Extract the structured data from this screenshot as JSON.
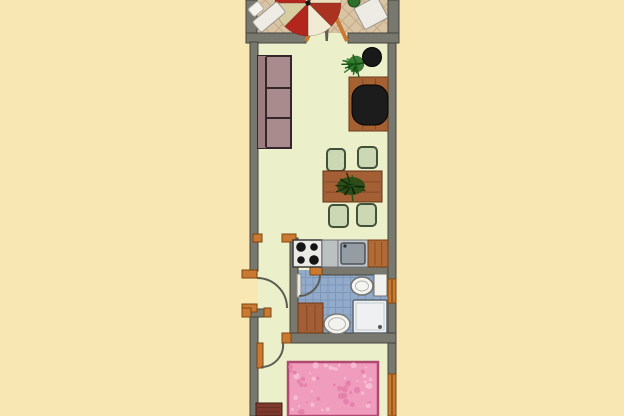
{
  "title": "apartment-floor-plan",
  "canvas": {
    "w": 624,
    "h": 416,
    "bg": "#f8e7b2"
  },
  "palette": {
    "background": "#f8e7b2",
    "wall": "#78786f",
    "wall_edge": "#45453e",
    "floor_main": "#ebefca",
    "floor_balcony": "#d9c4a4",
    "floor_bath": "#93abca",
    "wood_frame": "#c97a30",
    "wood_frame_edge": "#7d450f",
    "arc": "#5c5c54",
    "bed_pink": "#ef9cbd",
    "umbrella_red": "#b2261e"
  },
  "elements": [
    {
      "name": "background",
      "type": "rect",
      "x": 0,
      "y": 0,
      "w": 624,
      "h": 416,
      "fill": "#f8e7b2"
    },
    {
      "name": "balcony-floor",
      "type": "rect",
      "x": 257,
      "y": 0,
      "w": 131,
      "h": 34,
      "fill": "#d9c4a4"
    },
    {
      "name": "balcony-floor-tiles",
      "type": "tiles",
      "mode": "diag",
      "x": 257,
      "y": 0,
      "w": 131,
      "h": 34,
      "s": 14,
      "stroke": "#c7ab89",
      "sw": 1
    },
    {
      "name": "main-floor",
      "type": "rect",
      "x": 258,
      "y": 33,
      "w": 130,
      "h": 383,
      "fill": "#ebefca"
    },
    {
      "name": "bathroom-floor",
      "type": "rect",
      "x": 298,
      "y": 270,
      "w": 90,
      "h": 73,
      "fill": "#93abca"
    },
    {
      "name": "bathroom-floor-tiles",
      "type": "tiles",
      "mode": "grid",
      "x": 298,
      "y": 270,
      "w": 90,
      "h": 73,
      "s": 7.5,
      "stroke": "#7d97b9",
      "sw": 1
    },
    {
      "name": "balcony-left-wall",
      "type": "rect",
      "x": 246,
      "y": 0,
      "w": 11,
      "h": 43,
      "fill": "#78786f",
      "stroke": "#45453e"
    },
    {
      "name": "balcony-right-wall",
      "type": "rect",
      "x": 388,
      "y": 0,
      "w": 11,
      "h": 43,
      "fill": "#78786f",
      "stroke": "#45453e"
    },
    {
      "name": "balcony-parapet-left",
      "type": "rect",
      "x": 246,
      "y": 33,
      "w": 60,
      "h": 10,
      "fill": "#78786f",
      "stroke": "#45453e"
    },
    {
      "name": "balcony-parapet-right",
      "type": "rect",
      "x": 348,
      "y": 33,
      "w": 51,
      "h": 10,
      "fill": "#78786f",
      "stroke": "#45453e"
    },
    {
      "name": "left-wall-upper",
      "type": "rect",
      "x": 250,
      "y": 42,
      "w": 8,
      "h": 229,
      "fill": "#78786f",
      "stroke": "#45453e"
    },
    {
      "name": "left-wall-lower",
      "type": "rect",
      "x": 250,
      "y": 312,
      "w": 8,
      "h": 104,
      "fill": "#78786f",
      "stroke": "#45453e"
    },
    {
      "name": "right-wall-upper",
      "type": "rect",
      "x": 388,
      "y": 43,
      "w": 8,
      "h": 236,
      "fill": "#78786f",
      "stroke": "#45453e"
    },
    {
      "name": "right-wall-mid",
      "type": "rect",
      "x": 388,
      "y": 303,
      "w": 8,
      "h": 71,
      "fill": "#78786f",
      "stroke": "#45453e"
    },
    {
      "name": "kitchen-bathroom-wall",
      "type": "rect",
      "x": 290,
      "y": 238,
      "w": 8,
      "h": 105,
      "fill": "#78786f",
      "stroke": "#45453e"
    },
    {
      "name": "bathroom-top-wall",
      "type": "rect",
      "x": 322,
      "y": 266,
      "w": 66,
      "h": 9,
      "fill": "#78786f",
      "stroke": "#45453e"
    },
    {
      "name": "bathroom-bottom-wall",
      "type": "rect",
      "x": 290,
      "y": 333,
      "w": 106,
      "h": 10,
      "fill": "#78786f",
      "stroke": "#45453e"
    },
    {
      "name": "hallway-stub-wall",
      "type": "rect",
      "x": 250,
      "y": 309,
      "w": 18,
      "h": 8,
      "fill": "#78786f",
      "stroke": "#45453e"
    },
    {
      "name": "entry-door-jamb-top",
      "type": "rect",
      "x": 242,
      "y": 270,
      "w": 15,
      "h": 8,
      "fill": "#c97a30",
      "stroke": "#7d450f"
    },
    {
      "name": "entry-door-jamb-bottom",
      "type": "rect",
      "x": 242,
      "y": 304,
      "w": 15,
      "h": 8,
      "fill": "#c97a30",
      "stroke": "#7d450f"
    },
    {
      "name": "corridor-jamb-left",
      "type": "rect",
      "x": 253,
      "y": 234,
      "w": 9,
      "h": 8,
      "fill": "#c97a30",
      "stroke": "#7d450f"
    },
    {
      "name": "corridor-jamb-right",
      "type": "rect",
      "x": 282,
      "y": 234,
      "w": 14,
      "h": 8,
      "fill": "#c97a30",
      "stroke": "#7d450f"
    },
    {
      "name": "stub-wall-cap-left",
      "type": "rect",
      "x": 242,
      "y": 308,
      "w": 9,
      "h": 9,
      "fill": "#c97a30",
      "stroke": "#7d450f"
    },
    {
      "name": "stub-wall-cap-right",
      "type": "rect",
      "x": 264,
      "y": 308,
      "w": 7,
      "h": 9,
      "fill": "#c97a30",
      "stroke": "#7d450f"
    },
    {
      "name": "bathroom-door-jamb",
      "type": "rect",
      "x": 310,
      "y": 266,
      "w": 12,
      "h": 9,
      "fill": "#c97a30",
      "stroke": "#7d450f"
    },
    {
      "name": "bedroom-door-jamb",
      "type": "rect",
      "x": 282,
      "y": 333,
      "w": 9,
      "h": 10,
      "fill": "#c97a30",
      "stroke": "#7d450f"
    },
    {
      "name": "bathroom-window",
      "type": "window",
      "x": 388,
      "y": 279,
      "w": 8,
      "h": 24,
      "fill": "#c97a30",
      "stroke": "#7d450f"
    },
    {
      "name": "bedroom-window",
      "type": "window",
      "x": 388,
      "y": 374,
      "w": 8,
      "h": 42,
      "fill": "#c97a30",
      "stroke": "#7d450f"
    },
    {
      "name": "balcony-door-panel-left",
      "type": "line",
      "x1": 306,
      "y1": 41,
      "x2": 322,
      "y2": 7,
      "stroke": "#c97a30",
      "sw": 4
    },
    {
      "name": "balcony-door-panel-right",
      "type": "line",
      "x1": 347,
      "y1": 41,
      "x2": 331,
      "y2": 7,
      "stroke": "#c97a30",
      "sw": 4
    },
    {
      "name": "balcony-door-arc-left",
      "type": "path",
      "d": "M322,7 Q326,27 326.5,41",
      "stroke": "#5c5c54",
      "sw": 1.8
    },
    {
      "name": "balcony-door-arc-right",
      "type": "path",
      "d": "M331,7 Q327.5,27 327,41",
      "stroke": "#5c5c54",
      "sw": 1.8
    },
    {
      "name": "entry-door-arc",
      "type": "path",
      "d": "M257,278 A30,30 0 0 1 287,308",
      "stroke": "#5c5c54",
      "sw": 2
    },
    {
      "name": "bathroom-door-panel",
      "type": "rect",
      "x": 297,
      "y": 274,
      "w": 4,
      "h": 23,
      "fill": "#e9e9e6",
      "stroke": "#8a8a84"
    },
    {
      "name": "bathroom-door-arc",
      "type": "path",
      "d": "M320,275 A21,21 0 0 1 299,296",
      "stroke": "#5c5c54",
      "sw": 2
    },
    {
      "name": "bedroom-door-panel",
      "type": "rect",
      "x": 257,
      "y": 343,
      "w": 6,
      "h": 25,
      "fill": "#c97a30",
      "stroke": "#7d450f"
    },
    {
      "name": "bedroom-door-arc",
      "type": "path",
      "d": "M283,343 A22,22 0 0 1 261,367",
      "stroke": "#5c5c54",
      "sw": 2
    },
    {
      "name": "patio-umbrella",
      "type": "umbrella",
      "cx": 308,
      "cy": 3,
      "r": 33,
      "wedges": [
        "#b2261e",
        "#e9dfba",
        "#a93220",
        "#f1ebd3",
        "#b2261e",
        "#d8cda0",
        "#b2261e",
        "#ece3c1"
      ],
      "pole": "#161616"
    },
    {
      "name": "balcony-lounger",
      "type": "rotrect",
      "cx": 269,
      "cy": 17,
      "w": 32,
      "h": 14,
      "rot": -40,
      "fill": "#efece6",
      "stroke": "#97978f"
    },
    {
      "name": "balcony-lounger-cushion",
      "type": "rotrect",
      "cx": 256,
      "cy": 9,
      "w": 13,
      "h": 10,
      "rot": -40,
      "fill": "#f4f2ec",
      "stroke": "#b0b0a8"
    },
    {
      "name": "balcony-chair",
      "type": "rotrect",
      "cx": 371,
      "cy": 13,
      "w": 26,
      "h": 24,
      "rot": -28,
      "fill": "#eeebe4",
      "stroke": "#97978f"
    },
    {
      "name": "balcony-plant",
      "type": "circle",
      "cx": 354,
      "cy": 1,
      "r": 6,
      "fill": "#2f6e2b",
      "stroke": "#1c4a18"
    },
    {
      "name": "sofa-body",
      "type": "rect",
      "x": 258,
      "y": 56,
      "w": 33,
      "h": 92,
      "fill": "#a98b8e",
      "stroke": "#35262c",
      "sw": 2
    },
    {
      "name": "sofa-backrest",
      "type": "rect",
      "x": 258,
      "y": 56,
      "w": 8,
      "h": 92,
      "fill": "#9b7d80"
    },
    {
      "name": "sofa-seam-back",
      "type": "line",
      "x1": 266,
      "y1": 57,
      "x2": 266,
      "y2": 147,
      "stroke": "#35262c",
      "sw": 2
    },
    {
      "name": "sofa-seam-1",
      "type": "line",
      "x1": 266,
      "y1": 88,
      "x2": 290,
      "y2": 88,
      "stroke": "#35262c",
      "sw": 2
    },
    {
      "name": "sofa-seam-2",
      "type": "line",
      "x1": 266,
      "y1": 118,
      "x2": 290,
      "y2": 118,
      "stroke": "#35262c",
      "sw": 2
    },
    {
      "name": "desk",
      "type": "wood",
      "x": 349,
      "y": 77,
      "w": 39,
      "h": 54,
      "fill": "#a66133",
      "stroke": "#6b3a18"
    },
    {
      "name": "desk-chair",
      "type": "rect",
      "x": 352,
      "y": 85,
      "w": 36,
      "h": 40,
      "rx": 13,
      "fill": "#1c1c1c",
      "stroke": "#000000"
    },
    {
      "name": "living-plant",
      "type": "burst",
      "cx": 356,
      "cy": 64,
      "r": 15,
      "colors": [
        "#1d5c1d",
        "#2e7d2a",
        "#0f4a10"
      ],
      "base": "#2a6e26"
    },
    {
      "name": "side-stool",
      "type": "circle",
      "cx": 372,
      "cy": 57,
      "r": 9.5,
      "fill": "#191919",
      "stroke": "#000000"
    },
    {
      "name": "dining-chair-1",
      "type": "rect",
      "x": 327,
      "y": 149,
      "w": 18,
      "h": 22,
      "rx": 4,
      "fill": "#cbd8b3",
      "stroke": "#43513a",
      "sw": 2
    },
    {
      "name": "dining-chair-2",
      "type": "rect",
      "x": 358,
      "y": 147,
      "w": 19,
      "h": 21,
      "rx": 4,
      "fill": "#cbd8b3",
      "stroke": "#43513a",
      "sw": 2
    },
    {
      "name": "dining-chair-3",
      "type": "rect",
      "x": 329,
      "y": 205,
      "w": 19,
      "h": 22,
      "rx": 4,
      "fill": "#cbd8b3",
      "stroke": "#43513a",
      "sw": 2
    },
    {
      "name": "dining-chair-4",
      "type": "rect",
      "x": 357,
      "y": 204,
      "w": 19,
      "h": 22,
      "rx": 4,
      "fill": "#cbd8b3",
      "stroke": "#43513a",
      "sw": 2
    },
    {
      "name": "dining-table",
      "type": "wood",
      "x": 323,
      "y": 171,
      "w": 59,
      "h": 31,
      "fill": "#a55f35",
      "stroke": "#5f3316"
    },
    {
      "name": "table-centerpiece-base",
      "type": "ellipse",
      "cx": 351,
      "cy": 186,
      "rx": 14,
      "ry": 9,
      "fill": "#1d4a12",
      "stroke": "none",
      "opacity": 0.85
    },
    {
      "name": "table-centerpiece-plant",
      "type": "burst",
      "cx": 351,
      "cy": 186,
      "r": 16,
      "colors": [
        "#14320d",
        "#0c230a",
        "#25511a"
      ],
      "base": "none"
    },
    {
      "name": "stove",
      "type": "rect",
      "x": 293,
      "y": 240,
      "w": 29,
      "h": 27,
      "fill": "#e9e9e5",
      "stroke": "#3a3a3a",
      "sw": 1.5
    },
    {
      "name": "stove-burner-1",
      "type": "circle",
      "cx": 301,
      "cy": 247,
      "r": 4.8,
      "fill": "#141414"
    },
    {
      "name": "stove-burner-2",
      "type": "circle",
      "cx": 314,
      "cy": 247,
      "r": 3.8,
      "fill": "#141414"
    },
    {
      "name": "stove-burner-3",
      "type": "circle",
      "cx": 301,
      "cy": 260,
      "r": 3.8,
      "fill": "#141414"
    },
    {
      "name": "stove-burner-4",
      "type": "circle",
      "cx": 314,
      "cy": 260,
      "r": 4.8,
      "fill": "#141414"
    },
    {
      "name": "kitchen-counter",
      "type": "rect",
      "x": 322,
      "y": 240,
      "w": 16,
      "h": 27,
      "fill": "#bcc0c2",
      "stroke": "#6e7276"
    },
    {
      "name": "sink-unit",
      "type": "rect",
      "x": 338,
      "y": 240,
      "w": 30,
      "h": 27,
      "fill": "#c3c7c9",
      "stroke": "#6e7276"
    },
    {
      "name": "sink-basin",
      "type": "rect",
      "x": 341,
      "y": 243,
      "w": 24,
      "h": 21,
      "rx": 2,
      "fill": "#959ca4",
      "stroke": "#4b5157",
      "sw": 1.5
    },
    {
      "name": "sink-faucet",
      "type": "circle",
      "cx": 345,
      "cy": 246,
      "r": 1.6,
      "fill": "#2e2e2e"
    },
    {
      "name": "kitchen-counter-wood",
      "type": "wood",
      "x": 368,
      "y": 240,
      "w": 20,
      "h": 27,
      "fill": "#b06a36",
      "stroke": "#74401a"
    },
    {
      "name": "toilet-cistern",
      "type": "rect",
      "x": 374,
      "y": 274,
      "w": 13,
      "h": 22,
      "rx": 1,
      "fill": "#f1f1ed",
      "stroke": "#71716c"
    },
    {
      "name": "toilet-bowl",
      "type": "ellipse",
      "cx": 362,
      "cy": 286,
      "rx": 11,
      "ry": 9,
      "fill": "#f4f4f0",
      "stroke": "#71716c",
      "sw": 1.5
    },
    {
      "name": "toilet-bowl-inner",
      "type": "ellipse",
      "cx": 362,
      "cy": 286,
      "rx": 6.5,
      "ry": 5,
      "fill": "none",
      "stroke": "#b5b5b0"
    },
    {
      "name": "bathroom-cabinet",
      "type": "wood",
      "x": 298,
      "y": 303,
      "w": 25,
      "h": 30,
      "fill": "#a45e35",
      "stroke": "#6b3a18"
    },
    {
      "name": "shower-tray",
      "type": "rect",
      "x": 353,
      "y": 300,
      "w": 34,
      "h": 33,
      "rx": 2,
      "fill": "#eef0f2",
      "stroke": "#5e666e",
      "sw": 1.5
    },
    {
      "name": "shower-tray-inner",
      "type": "rect",
      "x": 356,
      "y": 303,
      "w": 28,
      "h": 27,
      "fill": "none",
      "stroke": "#c3cad0"
    },
    {
      "name": "shower-drain",
      "type": "circle",
      "cx": 380,
      "cy": 327,
      "r": 2,
      "fill": "#555555"
    },
    {
      "name": "washbasin",
      "type": "ellipse",
      "cx": 337,
      "cy": 324,
      "rx": 13,
      "ry": 10,
      "fill": "#f2f2ee",
      "stroke": "#7a7a75",
      "sw": 1.5
    },
    {
      "name": "washbasin-inner",
      "type": "ellipse",
      "cx": 337,
      "cy": 324,
      "rx": 8.5,
      "ry": 6.2,
      "fill": "none",
      "stroke": "#b5b5b0"
    },
    {
      "name": "bed",
      "type": "scatter",
      "x": 288,
      "y": 362,
      "w": 90,
      "h": 54,
      "fill": "#ef9cbd",
      "stroke": "#b04a72",
      "sw": 2.5,
      "dots": [
        "#f7c3d6",
        "#e27da8"
      ],
      "n": 55
    },
    {
      "name": "dresser",
      "type": "wood",
      "x": 256,
      "y": 403,
      "w": 26,
      "h": 13,
      "fill": "#7d392d",
      "stroke": "#421d12"
    }
  ]
}
